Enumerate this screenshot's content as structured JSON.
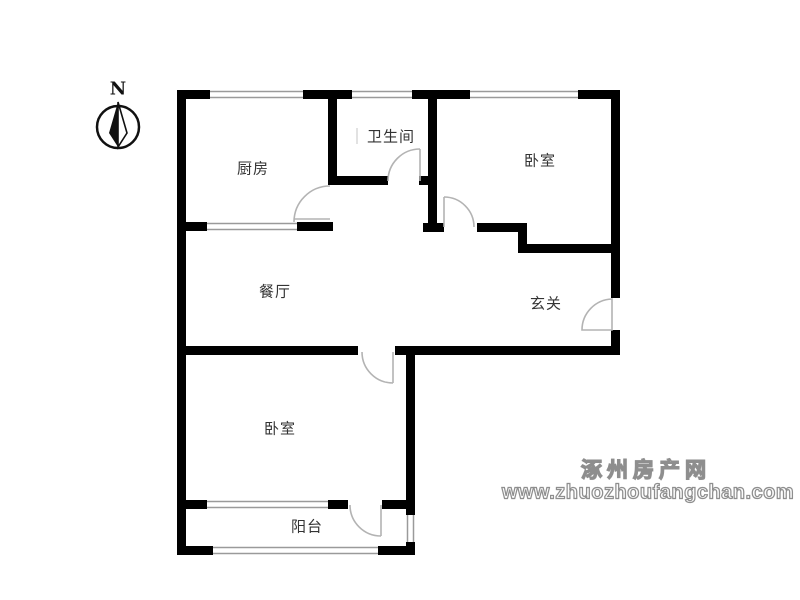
{
  "floorplan": {
    "rooms": [
      {
        "id": "kitchen",
        "label": "厨房"
      },
      {
        "id": "bathroom",
        "label": "卫生间"
      },
      {
        "id": "bedroom-north",
        "label": "卧室"
      },
      {
        "id": "dining-room",
        "label": "餐厅"
      },
      {
        "id": "entry-hall",
        "label": "玄关"
      },
      {
        "id": "bedroom-south",
        "label": "卧室"
      },
      {
        "id": "balcony",
        "label": "阳台"
      }
    ],
    "compass": {
      "label": "N"
    },
    "watermark": {
      "site_name": "涿州房产网",
      "url": "www.zhuozhoufangchan.com"
    },
    "colors": {
      "wall": "#000000",
      "window_line": "#9a9a9a",
      "door": "#b3b3b3",
      "label_text": "#333333",
      "watermark": "#8e8e8e"
    }
  }
}
